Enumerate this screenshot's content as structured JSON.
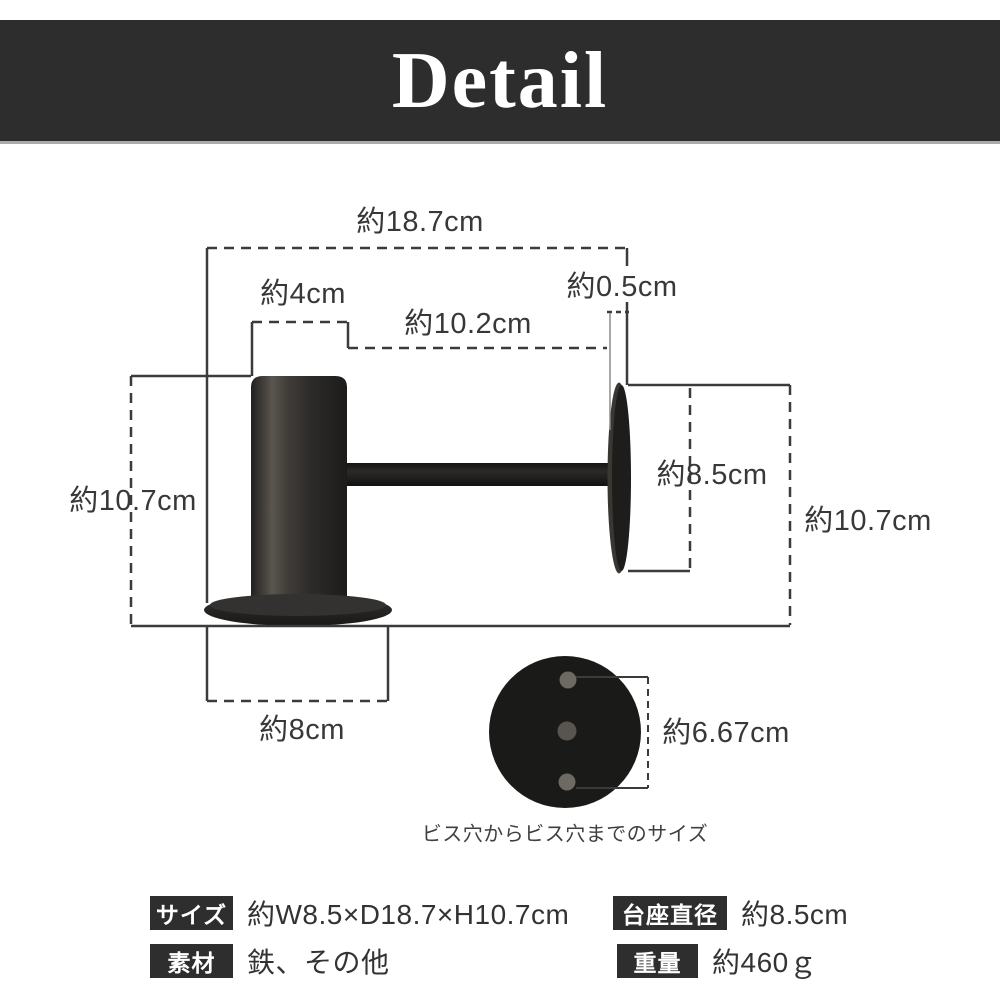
{
  "header": {
    "title": "Detail"
  },
  "diagram": {
    "dimensions": {
      "depth_total": "約18.7cm",
      "pole_diameter": "約4cm",
      "arm_length": "約10.2cm",
      "plate_thickness": "約0.5cm",
      "height_left": "約10.7cm",
      "base_width": "約8cm",
      "plate_diameter": "約8.5cm",
      "height_right": "約10.7cm",
      "screw_hole_distance": "約6.67cm"
    },
    "caption": "ビス穴からビス穴までのサイズ"
  },
  "specs": {
    "rows": [
      {
        "label": "サイズ",
        "value": "約W8.5×D18.7×H10.7cm"
      },
      {
        "label": "素材",
        "value": "鉄、その他"
      },
      {
        "label": "台座直径",
        "value": "約8.5cm"
      },
      {
        "label": "重量",
        "value": "約460ｇ"
      }
    ]
  },
  "colors": {
    "header_bg": "#2d2d2d",
    "badge_bg": "#2e2e2e",
    "dimension_line": "#3b3b3b",
    "product_dark": "#1d1c1b",
    "screw_dot": "#6d6963"
  }
}
